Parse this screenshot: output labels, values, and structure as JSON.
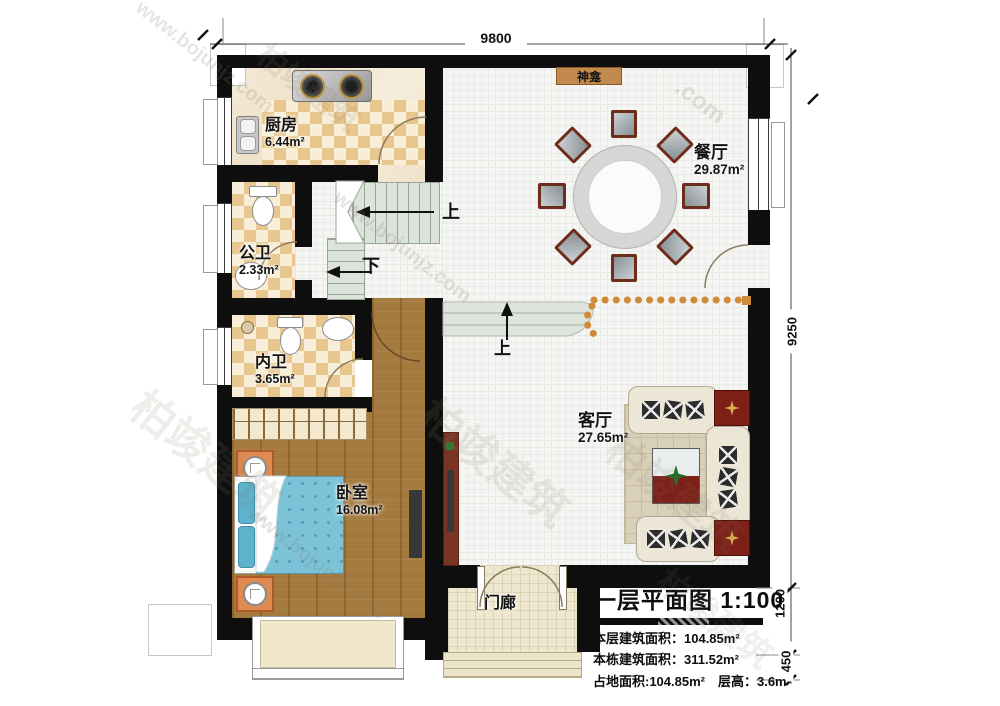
{
  "watermark": {
    "site": "www.bojunjz.com",
    "brand": "柏竣建筑",
    "com": ".com"
  },
  "dimensions": {
    "top": "9800",
    "right": "9250",
    "porch_height": "1200",
    "steps": "450"
  },
  "rooms": {
    "kitchen": {
      "name": "厨房",
      "area": "6.44m²"
    },
    "public_bath": {
      "name": "公卫",
      "area": "2.33m²"
    },
    "private_bath": {
      "name": "内卫",
      "area": "3.65m²"
    },
    "bedroom": {
      "name": "卧室",
      "area": "16.08m²"
    },
    "dining": {
      "name": "餐厅",
      "area": "29.87m²"
    },
    "living": {
      "name": "客厅",
      "area": "27.65m²"
    },
    "porch": {
      "name": "门廊"
    },
    "shrine": {
      "name": "神龛"
    }
  },
  "stairs": {
    "up_label": "上",
    "down_label": "下",
    "ramp_up_label": "上"
  },
  "title_block": {
    "title": "一层平面图",
    "scale": "1:100",
    "line1": "本层建筑面积：104.85m²",
    "line2": "本栋建筑面积：311.52m²",
    "line3": "占地面积:104.85m²　层高：3.6m"
  }
}
